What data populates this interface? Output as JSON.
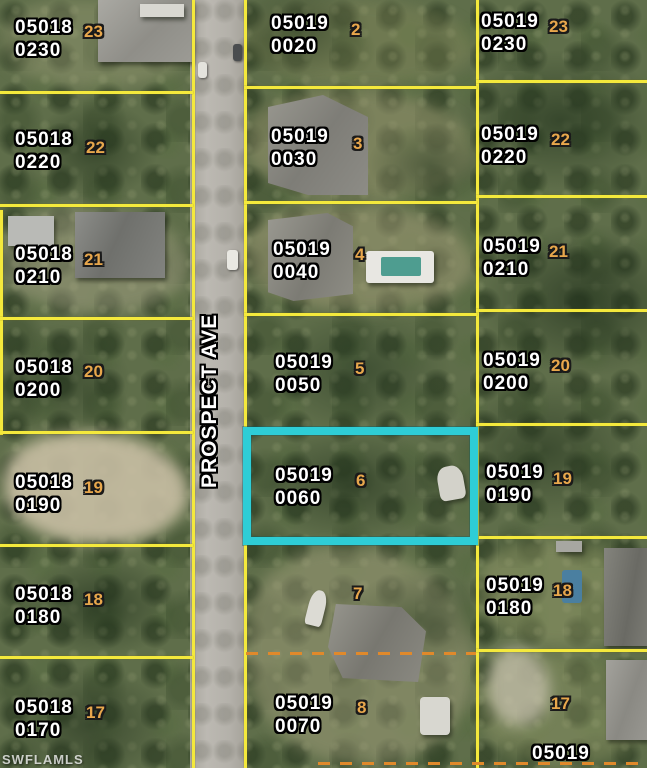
{
  "map": {
    "road_label": "PROSPECT AVE",
    "watermark": "SWFLAMLS",
    "colors": {
      "highlight_border": "#2ecdd6",
      "parcel_line": "#f4e93c",
      "dashed_line": "#e0892b",
      "strap_text": "#ffffff",
      "lot_text": "#e8a74c"
    },
    "highlighted_parcel": {
      "strap": "05019 0060",
      "lot": "6"
    }
  },
  "parcels": [
    {
      "book": "05018",
      "page": "0230",
      "lot": "23"
    },
    {
      "book": "05018",
      "page": "0220",
      "lot": "22"
    },
    {
      "book": "05018",
      "page": "0210",
      "lot": "21"
    },
    {
      "book": "05018",
      "page": "0200",
      "lot": "20"
    },
    {
      "book": "05018",
      "page": "0190",
      "lot": "19"
    },
    {
      "book": "05018",
      "page": "0180",
      "lot": "18"
    },
    {
      "book": "05018",
      "page": "0170",
      "lot": "17"
    },
    {
      "book": "05019",
      "page": "0020",
      "lot": "2"
    },
    {
      "book": "05019",
      "page": "0030",
      "lot": "3"
    },
    {
      "book": "05019",
      "page": "0040",
      "lot": "4"
    },
    {
      "book": "05019",
      "page": "0050",
      "lot": "5"
    },
    {
      "book": "05019",
      "page": "0060",
      "lot": "6"
    },
    {
      "lot": "7"
    },
    {
      "book": "05019",
      "page": "0070",
      "lot": "8"
    },
    {
      "book": "05019",
      "page": "0230",
      "lot": "23"
    },
    {
      "book": "05019",
      "page": "0220",
      "lot": "22"
    },
    {
      "book": "05019",
      "page": "0210",
      "lot": "21"
    },
    {
      "book": "05019",
      "page": "0200",
      "lot": "20"
    },
    {
      "book": "05019",
      "page": "0190",
      "lot": "19"
    },
    {
      "book": "05019",
      "page": "0180",
      "lot": "18"
    },
    {
      "lot": "17"
    },
    {
      "book": "05019"
    }
  ]
}
